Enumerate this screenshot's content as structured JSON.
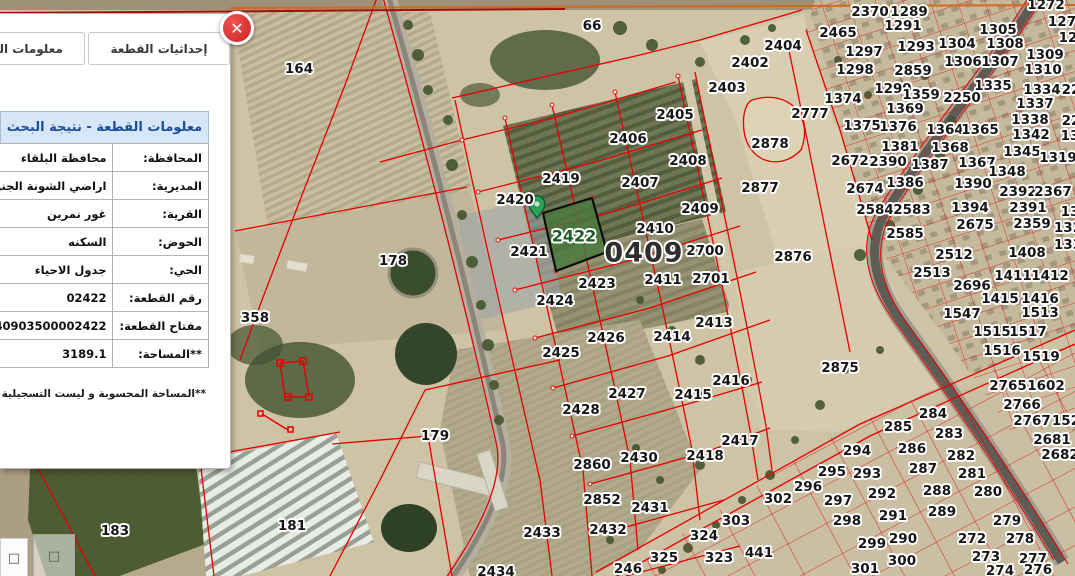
{
  "panel": {
    "close_glyph": "✕",
    "tabs": [
      {
        "label": "معلومات القطعة"
      },
      {
        "label": "إحداثيات القطعة"
      }
    ],
    "table": {
      "title": "معلومات القطعة - نتيجة البحث",
      "rows": [
        {
          "label": "المحافظة:",
          "value": "محافظة البلقاء"
        },
        {
          "label": "المديرية:",
          "value": "اراضي الشونة الجنوبية"
        },
        {
          "label": "القرية:",
          "value": "غور نمرين"
        },
        {
          "label": "الحوض:",
          "value": "السكنه"
        },
        {
          "label": "الحي:",
          "value": "جدول الاحياء"
        },
        {
          "label": "رقم القطعة:",
          "value": "02422"
        },
        {
          "label": "مفتاح القطعة:",
          "value": "40903500002422"
        },
        {
          "label": "**المساحة:",
          "value": "3189.1"
        }
      ],
      "footnote": "**المساحة المحسوبة و ليست التسجيلية"
    }
  },
  "controls": {
    "buttons": [
      {
        "glyph": "□"
      },
      {
        "glyph": "□"
      }
    ]
  },
  "map": {
    "colors": {
      "parcel_line_red": "#e60000",
      "selected_parcel_fill": "#4b7a3e",
      "selected_label_green": "#1c5a26",
      "pin_green": "#2fa05a",
      "header_blue": "#1b4d9e",
      "close_red": "#d32f2f"
    },
    "block_label": {
      "text": "0409"
    },
    "selected_parcel": {
      "number": "2422"
    },
    "labels": [
      {
        "t": "66",
        "x": 592,
        "y": 26
      },
      {
        "t": "164",
        "x": 299,
        "y": 69
      },
      {
        "t": "2404",
        "x": 783,
        "y": 46
      },
      {
        "t": "2402",
        "x": 750,
        "y": 63
      },
      {
        "t": "2403",
        "x": 727,
        "y": 88
      },
      {
        "t": "2405",
        "x": 675,
        "y": 115
      },
      {
        "t": "2406",
        "x": 628,
        "y": 139
      },
      {
        "t": "2408",
        "x": 688,
        "y": 161
      },
      {
        "t": "2407",
        "x": 640,
        "y": 183
      },
      {
        "t": "2419",
        "x": 561,
        "y": 179
      },
      {
        "t": "2420",
        "x": 515,
        "y": 200
      },
      {
        "t": "2421",
        "x": 529,
        "y": 252
      },
      {
        "t": "2423",
        "x": 597,
        "y": 284
      },
      {
        "t": "2424",
        "x": 555,
        "y": 301
      },
      {
        "t": "2426",
        "x": 606,
        "y": 338
      },
      {
        "t": "2425",
        "x": 561,
        "y": 353
      },
      {
        "t": "2427",
        "x": 627,
        "y": 394
      },
      {
        "t": "2428",
        "x": 581,
        "y": 410
      },
      {
        "t": "2409",
        "x": 700,
        "y": 209
      },
      {
        "t": "2410",
        "x": 655,
        "y": 229
      },
      {
        "t": "2700",
        "x": 705,
        "y": 251
      },
      {
        "t": "2411",
        "x": 663,
        "y": 280
      },
      {
        "t": "2701",
        "x": 711,
        "y": 279
      },
      {
        "t": "2413",
        "x": 714,
        "y": 323
      },
      {
        "t": "2414",
        "x": 672,
        "y": 337
      },
      {
        "t": "2416",
        "x": 731,
        "y": 381
      },
      {
        "t": "2415",
        "x": 693,
        "y": 395
      },
      {
        "t": "2417",
        "x": 740,
        "y": 441
      },
      {
        "t": "2418",
        "x": 705,
        "y": 456
      },
      {
        "t": "2430",
        "x": 639,
        "y": 458
      },
      {
        "t": "2860",
        "x": 592,
        "y": 465
      },
      {
        "t": "2852",
        "x": 602,
        "y": 500
      },
      {
        "t": "2431",
        "x": 650,
        "y": 508
      },
      {
        "t": "2432",
        "x": 608,
        "y": 530
      },
      {
        "t": "2433",
        "x": 542,
        "y": 533
      },
      {
        "t": "2434",
        "x": 496,
        "y": 572
      },
      {
        "t": "246",
        "x": 628,
        "y": 569
      },
      {
        "t": "325",
        "x": 664,
        "y": 558
      },
      {
        "t": "323",
        "x": 719,
        "y": 558
      },
      {
        "t": "441",
        "x": 759,
        "y": 553
      },
      {
        "t": "324",
        "x": 704,
        "y": 536
      },
      {
        "t": "303",
        "x": 736,
        "y": 521
      },
      {
        "t": "302",
        "x": 778,
        "y": 499
      },
      {
        "t": "296",
        "x": 808,
        "y": 487
      },
      {
        "t": "295",
        "x": 832,
        "y": 472
      },
      {
        "t": "293",
        "x": 867,
        "y": 474
      },
      {
        "t": "294",
        "x": 857,
        "y": 451
      },
      {
        "t": "297",
        "x": 838,
        "y": 501
      },
      {
        "t": "298",
        "x": 847,
        "y": 521
      },
      {
        "t": "299",
        "x": 872,
        "y": 544
      },
      {
        "t": "300",
        "x": 902,
        "y": 561
      },
      {
        "t": "301",
        "x": 865,
        "y": 569
      },
      {
        "t": "290",
        "x": 903,
        "y": 539
      },
      {
        "t": "291",
        "x": 893,
        "y": 516
      },
      {
        "t": "292",
        "x": 882,
        "y": 494
      },
      {
        "t": "288",
        "x": 937,
        "y": 491
      },
      {
        "t": "287",
        "x": 923,
        "y": 469
      },
      {
        "t": "286",
        "x": 912,
        "y": 449
      },
      {
        "t": "285",
        "x": 898,
        "y": 427
      },
      {
        "t": "284",
        "x": 933,
        "y": 414
      },
      {
        "t": "283",
        "x": 949,
        "y": 434
      },
      {
        "t": "282",
        "x": 961,
        "y": 456
      },
      {
        "t": "281",
        "x": 972,
        "y": 474
      },
      {
        "t": "280",
        "x": 988,
        "y": 492
      },
      {
        "t": "279",
        "x": 1007,
        "y": 521
      },
      {
        "t": "278",
        "x": 1020,
        "y": 539
      },
      {
        "t": "272",
        "x": 972,
        "y": 539
      },
      {
        "t": "273",
        "x": 986,
        "y": 557
      },
      {
        "t": "277",
        "x": 1033,
        "y": 559
      },
      {
        "t": "274",
        "x": 1000,
        "y": 571
      },
      {
        "t": "276",
        "x": 1038,
        "y": 570
      },
      {
        "t": "289",
        "x": 942,
        "y": 512
      },
      {
        "t": "2875",
        "x": 840,
        "y": 368
      },
      {
        "t": "2876",
        "x": 793,
        "y": 257
      },
      {
        "t": "2877",
        "x": 760,
        "y": 188
      },
      {
        "t": "2878",
        "x": 770,
        "y": 144
      },
      {
        "t": "178",
        "x": 393,
        "y": 261
      },
      {
        "t": "358",
        "x": 255,
        "y": 318
      },
      {
        "t": "179",
        "x": 435,
        "y": 436
      },
      {
        "t": "183",
        "x": 115,
        "y": 531
      },
      {
        "t": "181",
        "x": 292,
        "y": 526
      },
      {
        "t": "2370",
        "x": 870,
        "y": 12
      },
      {
        "t": "1289",
        "x": 909,
        "y": 12
      },
      {
        "t": "2465",
        "x": 838,
        "y": 33
      },
      {
        "t": "1291",
        "x": 903,
        "y": 26
      },
      {
        "t": "1297",
        "x": 864,
        "y": 52
      },
      {
        "t": "1293",
        "x": 916,
        "y": 47
      },
      {
        "t": "1304",
        "x": 957,
        "y": 44
      },
      {
        "t": "1305",
        "x": 998,
        "y": 30
      },
      {
        "t": "1308",
        "x": 1005,
        "y": 44
      },
      {
        "t": "1298",
        "x": 855,
        "y": 70
      },
      {
        "t": "2859",
        "x": 913,
        "y": 71
      },
      {
        "t": "1306",
        "x": 963,
        "y": 62
      },
      {
        "t": "1307",
        "x": 1000,
        "y": 62
      },
      {
        "t": "1309",
        "x": 1045,
        "y": 55
      },
      {
        "t": "1310",
        "x": 1043,
        "y": 70
      },
      {
        "t": "1299",
        "x": 893,
        "y": 89
      },
      {
        "t": "1359",
        "x": 921,
        "y": 95
      },
      {
        "t": "1374",
        "x": 843,
        "y": 99
      },
      {
        "t": "1335",
        "x": 993,
        "y": 86
      },
      {
        "t": "1334",
        "x": 1042,
        "y": 90
      },
      {
        "t": "1337",
        "x": 1035,
        "y": 104
      },
      {
        "t": "2250",
        "x": 962,
        "y": 98
      },
      {
        "t": "1369",
        "x": 905,
        "y": 109
      },
      {
        "t": "1338",
        "x": 1030,
        "y": 120
      },
      {
        "t": "2777",
        "x": 810,
        "y": 114
      },
      {
        "t": "1375",
        "x": 862,
        "y": 126
      },
      {
        "t": "1376",
        "x": 898,
        "y": 127
      },
      {
        "t": "1364",
        "x": 945,
        "y": 130
      },
      {
        "t": "1365",
        "x": 980,
        "y": 130
      },
      {
        "t": "1342",
        "x": 1031,
        "y": 135
      },
      {
        "t": "1381",
        "x": 900,
        "y": 147
      },
      {
        "t": "1368",
        "x": 950,
        "y": 148
      },
      {
        "t": "1345",
        "x": 1022,
        "y": 152
      },
      {
        "t": "1319",
        "x": 1058,
        "y": 158
      },
      {
        "t": "2672",
        "x": 850,
        "y": 161
      },
      {
        "t": "2390",
        "x": 888,
        "y": 162
      },
      {
        "t": "1387",
        "x": 930,
        "y": 165
      },
      {
        "t": "1367",
        "x": 977,
        "y": 163
      },
      {
        "t": "1348",
        "x": 1007,
        "y": 172
      },
      {
        "t": "1386",
        "x": 905,
        "y": 183
      },
      {
        "t": "1390",
        "x": 973,
        "y": 184
      },
      {
        "t": "2674",
        "x": 865,
        "y": 189
      },
      {
        "t": "2392",
        "x": 1018,
        "y": 192
      },
      {
        "t": "2367",
        "x": 1053,
        "y": 192
      },
      {
        "t": "2584",
        "x": 875,
        "y": 210
      },
      {
        "t": "2583",
        "x": 912,
        "y": 210
      },
      {
        "t": "1394",
        "x": 970,
        "y": 208
      },
      {
        "t": "2391",
        "x": 1028,
        "y": 208
      },
      {
        "t": "2675",
        "x": 975,
        "y": 225
      },
      {
        "t": "2359",
        "x": 1032,
        "y": 224
      },
      {
        "t": "2585",
        "x": 905,
        "y": 234
      },
      {
        "t": "2512",
        "x": 954,
        "y": 255
      },
      {
        "t": "1408",
        "x": 1027,
        "y": 253
      },
      {
        "t": "2513",
        "x": 932,
        "y": 273
      },
      {
        "t": "2696",
        "x": 972,
        "y": 286
      },
      {
        "t": "1411",
        "x": 1013,
        "y": 276
      },
      {
        "t": "1412",
        "x": 1050,
        "y": 276
      },
      {
        "t": "1415",
        "x": 1000,
        "y": 299
      },
      {
        "t": "1416",
        "x": 1040,
        "y": 299
      },
      {
        "t": "1547",
        "x": 962,
        "y": 314
      },
      {
        "t": "1513",
        "x": 1040,
        "y": 313
      },
      {
        "t": "1515",
        "x": 992,
        "y": 332
      },
      {
        "t": "1517",
        "x": 1028,
        "y": 332
      },
      {
        "t": "1516",
        "x": 1002,
        "y": 351
      },
      {
        "t": "1519",
        "x": 1041,
        "y": 357
      },
      {
        "t": "2765",
        "x": 1008,
        "y": 386
      },
      {
        "t": "1602",
        "x": 1046,
        "y": 386
      },
      {
        "t": "2766",
        "x": 1022,
        "y": 405
      },
      {
        "t": "2767",
        "x": 1032,
        "y": 421
      },
      {
        "t": "152",
        "x": 1066,
        "y": 421
      },
      {
        "t": "2681",
        "x": 1052,
        "y": 440
      },
      {
        "t": "2682",
        "x": 1060,
        "y": 455
      },
      {
        "t": "1272",
        "x": 1046,
        "y": 5
      },
      {
        "t": "127",
        "x": 1062,
        "y": 22
      },
      {
        "t": "12",
        "x": 1068,
        "y": 38
      },
      {
        "t": "22",
        "x": 1071,
        "y": 90
      },
      {
        "t": "22",
        "x": 1071,
        "y": 121
      },
      {
        "t": "13",
        "x": 1070,
        "y": 136
      },
      {
        "t": "13",
        "x": 1070,
        "y": 212
      },
      {
        "t": "132",
        "x": 1068,
        "y": 228
      },
      {
        "t": "133",
        "x": 1068,
        "y": 245
      }
    ]
  }
}
